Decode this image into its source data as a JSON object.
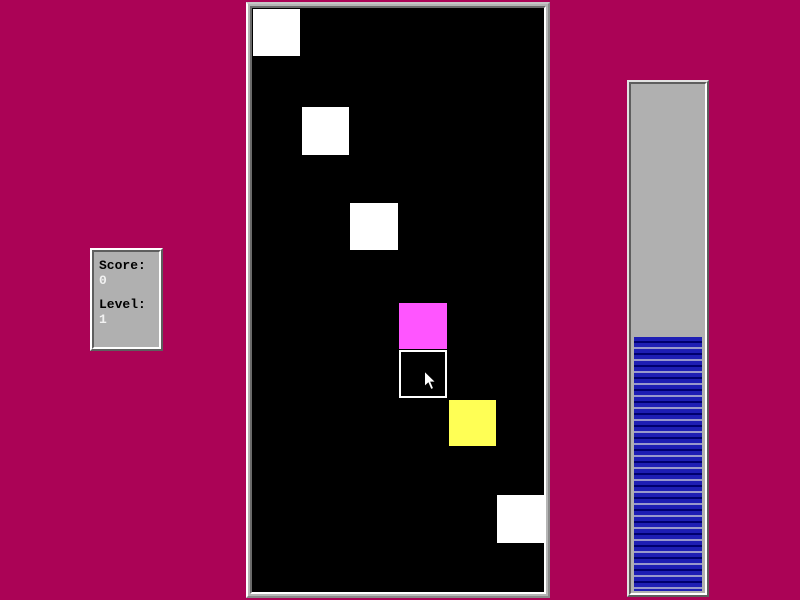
{
  "screen": {
    "width": 800,
    "height": 600,
    "background_color": "#ab0356"
  },
  "score_panel": {
    "background_color": "#b0b0b0",
    "score_label": "Score:",
    "score_value": "0",
    "level_label": "Level:",
    "level_value": "1"
  },
  "game_board": {
    "background_color": "#000000",
    "squares": [
      {
        "name": "white-square-1",
        "x": 1,
        "y": 1,
        "w": 47,
        "h": 47,
        "color": "#ffffff"
      },
      {
        "name": "white-square-2",
        "x": 50,
        "y": 99,
        "w": 47,
        "h": 48,
        "color": "#ffffff"
      },
      {
        "name": "white-square-3",
        "x": 98,
        "y": 195,
        "w": 48,
        "h": 47,
        "color": "#ffffff"
      },
      {
        "name": "magenta-square",
        "x": 147,
        "y": 295,
        "w": 48,
        "h": 46,
        "color": "#ff55ff"
      },
      {
        "name": "clicked-square",
        "x": 147,
        "y": 342,
        "w": 48,
        "h": 48,
        "color": "#000000",
        "border": "#ffffff"
      },
      {
        "name": "yellow-square",
        "x": 197,
        "y": 392,
        "w": 47,
        "h": 46,
        "color": "#ffff55"
      },
      {
        "name": "white-square-4",
        "x": 245,
        "y": 487,
        "w": 47,
        "h": 48,
        "color": "#ffffff"
      }
    ],
    "cursor": {
      "x": 170,
      "y": 362
    }
  },
  "timer_bar": {
    "fill_percent": 50,
    "track_color": "#b0b0b0",
    "stripe_blue": "#1e1eb4",
    "stripe_dark": "#00006e",
    "stripe_light": "#9898cc"
  }
}
